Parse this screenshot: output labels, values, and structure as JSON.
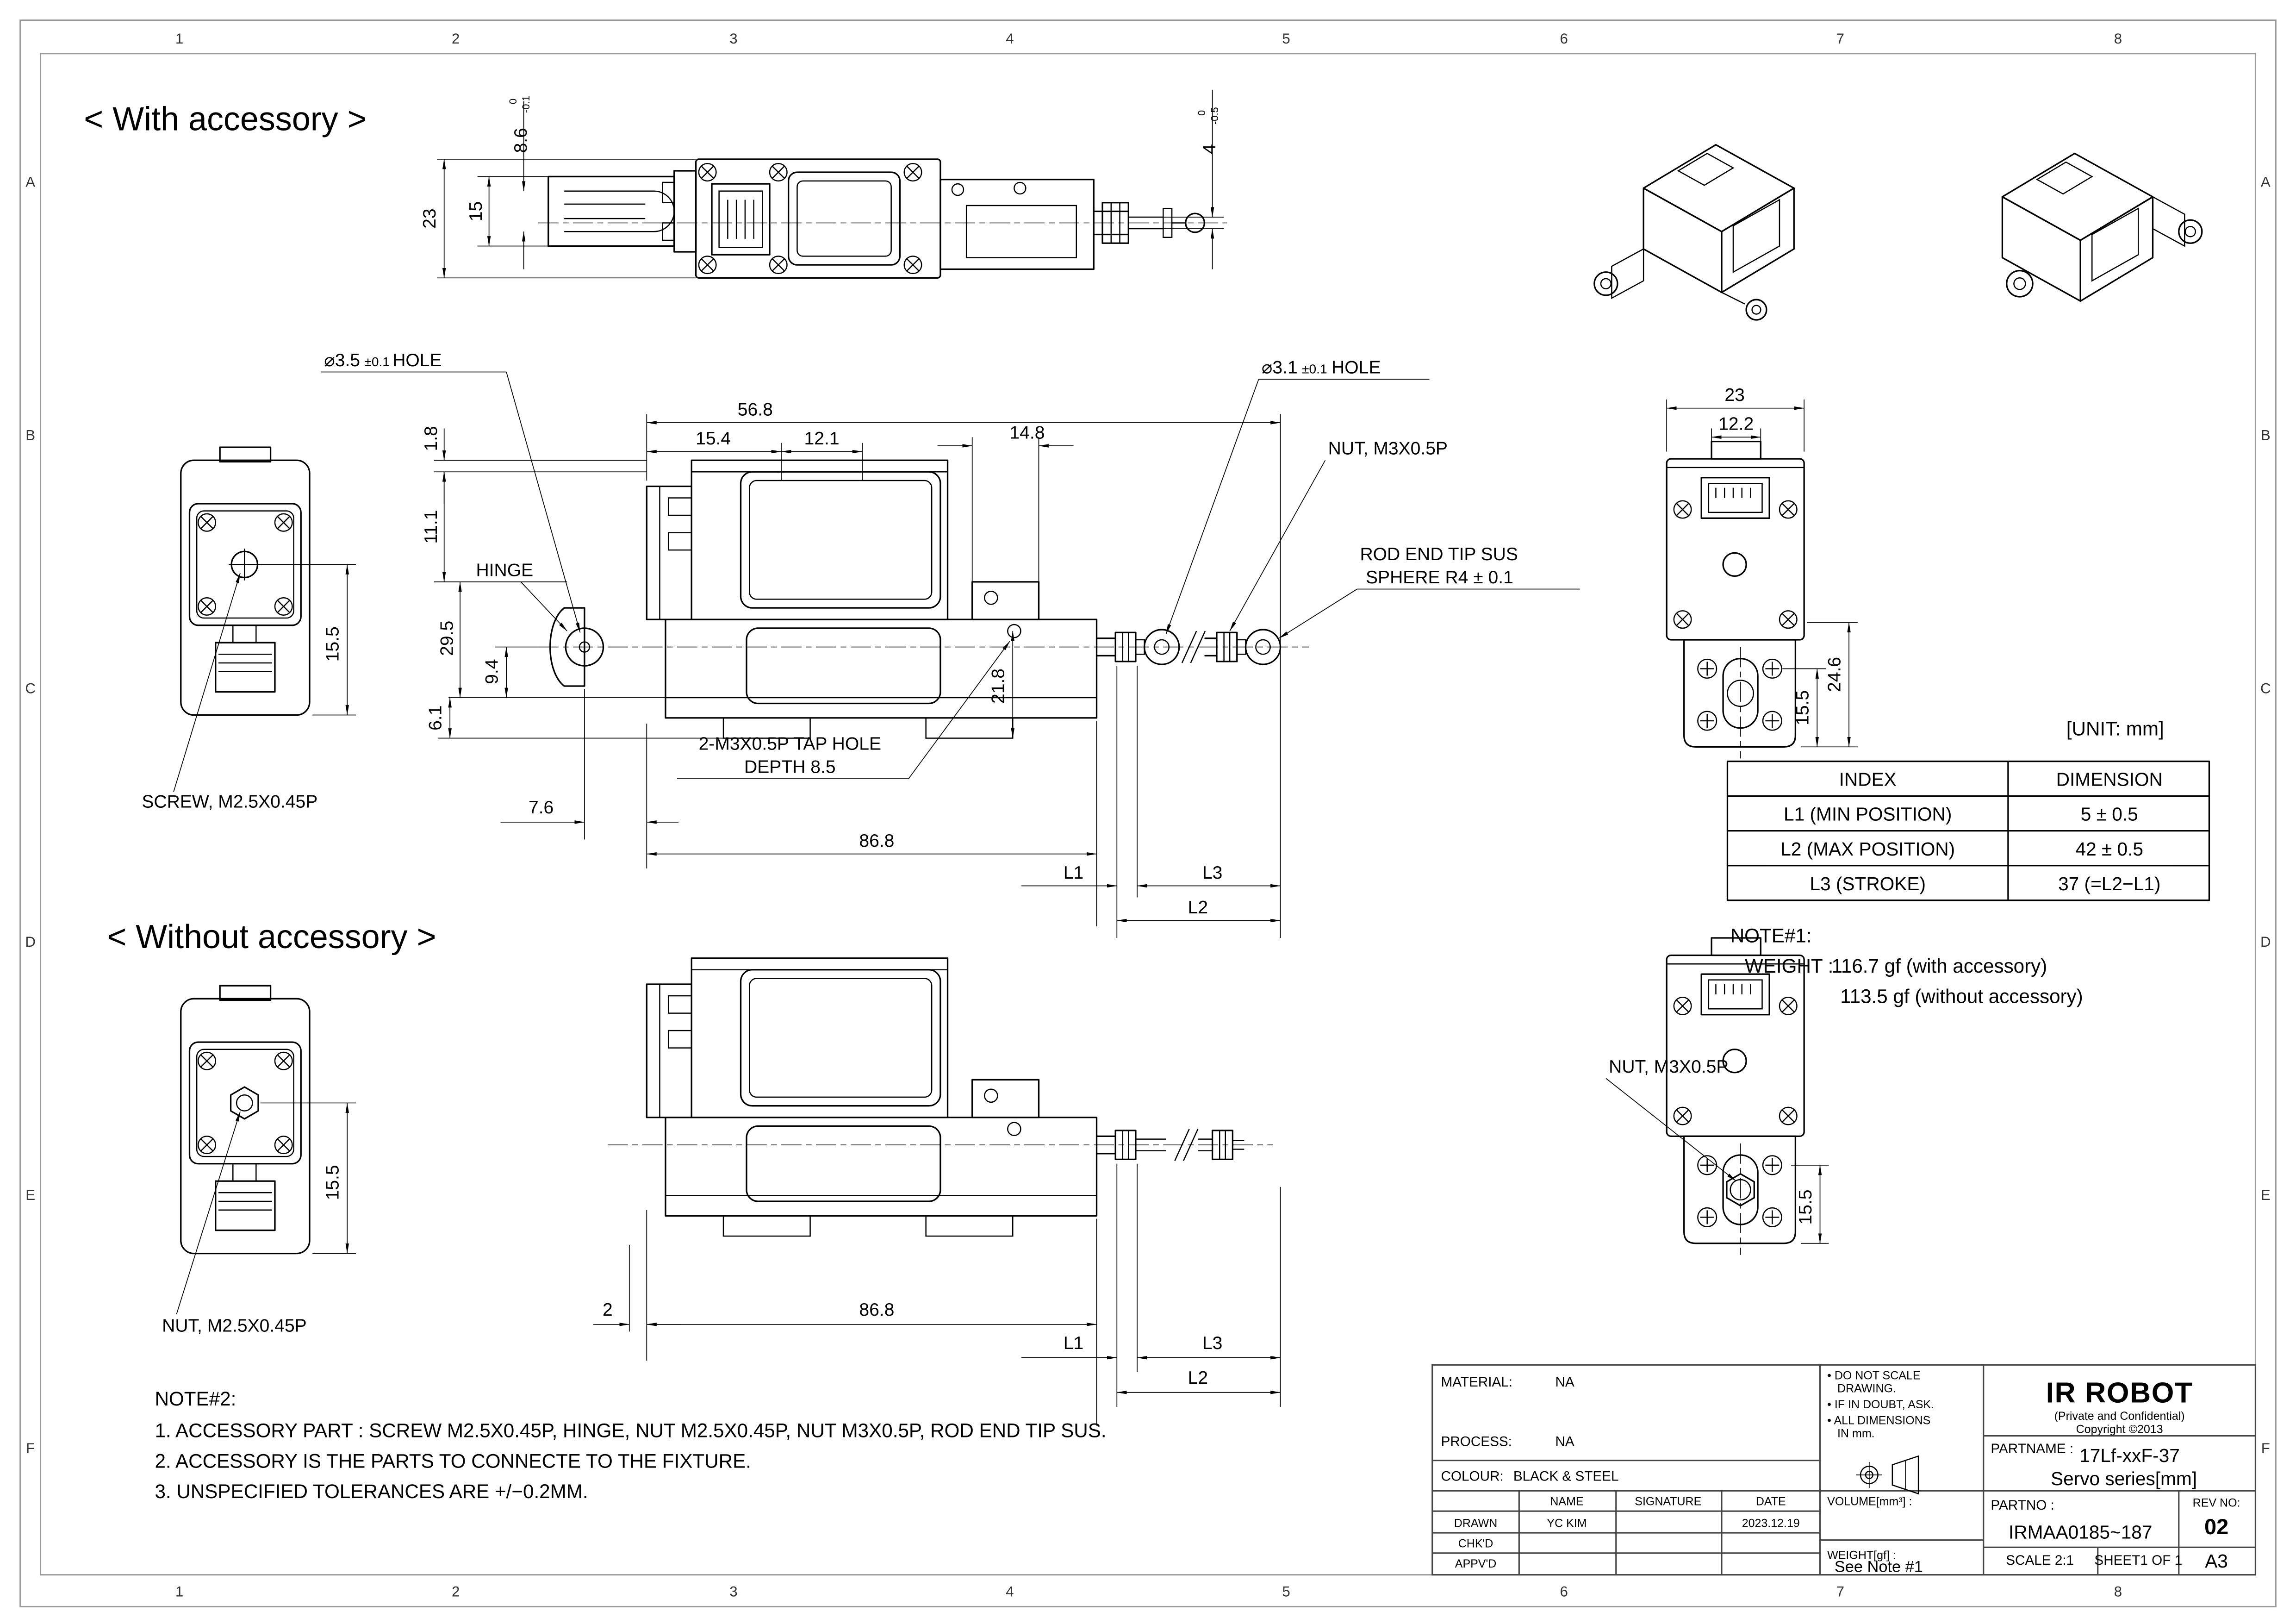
{
  "border": {
    "columns": [
      "1",
      "2",
      "3",
      "4",
      "5",
      "6",
      "7",
      "8"
    ],
    "rows": [
      "A",
      "B",
      "C",
      "D",
      "E",
      "F"
    ]
  },
  "sections": {
    "with_accessory": "< With accessory >",
    "without_accessory": "< Without accessory >"
  },
  "unit_note": "[UNIT: mm]",
  "dims": {
    "common": {
      "d155": "15.5",
      "l1": "L1",
      "l2": "L2",
      "l3": "L3",
      "d868": "86.8"
    },
    "top_view": {
      "d23": "23",
      "d15": "15",
      "d86": "8.6",
      "d86_hi": "0",
      "d86_lo": "-0.1",
      "d4": "4",
      "d4_hi": "0",
      "d4_lo": "-0.5"
    },
    "front_view": {
      "hole35": "⌀3.5",
      "hole35_tol": "±0.1",
      "hole35_suffix": "HOLE",
      "d568": "56.8",
      "d154": "15.4",
      "d121": "12.1",
      "d18": "1.8",
      "d111": "11.1",
      "d295": "29.5",
      "d94": "9.4",
      "d61": "6.1",
      "d76": "7.6",
      "d148": "14.8",
      "d218": "21.8",
      "hinge": "HINGE",
      "screw": "SCREW, M2.5X0.45P",
      "tap1": "2-M3X0.5P TAP HOLE",
      "tap2": "DEPTH 8.5",
      "hole31": "⌀3.1",
      "hole31_tol": "±0.1",
      "hole31_suffix": "HOLE",
      "nut_m3": "NUT, M3X0.5P",
      "rod1": "ROD END TIP SUS",
      "rod2": "SPHERE R4 ± 0.1"
    },
    "right_view": {
      "d23": "23",
      "d122": "12.2",
      "d246": "24.6"
    },
    "bottom_view": {
      "d2": "2",
      "nut_m25": "NUT, M2.5X0.45P",
      "nut_m3": "NUT, M3X0.5P"
    }
  },
  "index_table": {
    "headers": [
      "INDEX",
      "DIMENSION"
    ],
    "rows": [
      [
        "L1 (MIN POSITION)",
        "5 ± 0.5"
      ],
      [
        "L2 (MAX POSITION)",
        "42 ± 0.5"
      ],
      [
        "L3 (STROKE)",
        "37 (=L2−L1)"
      ]
    ]
  },
  "note1": {
    "title": "NOTE#1:",
    "weight_label": "WEIGHT :",
    "line1": "116.7 gf  (with accessory)",
    "line2": "113.5 gf  (without accessory)"
  },
  "note2": {
    "title": "NOTE#2:",
    "item1": "1. ACCESSORY PART :  SCREW M2.5X0.45P, HINGE, NUT M2.5X0.45P, NUT M3X0.5P, ROD END TIP SUS.",
    "item2": "2. ACCESSORY IS THE PARTS TO CONNECTE TO THE FIXTURE.",
    "item3": "3. UNSPECIFIED TOLERANCES ARE +/−0.2MM."
  },
  "title_block": {
    "material_label": "MATERIAL:",
    "material_value": "NA",
    "process_label": "PROCESS:",
    "process_value": "NA",
    "colour_label": "COLOUR:",
    "colour_value": "BLACK & STEEL",
    "col_name": "NAME",
    "col_signature": "SIGNATURE",
    "col_date": "DATE",
    "row_drawn": "DRAWN",
    "row_chkd": "CHK'D",
    "row_appvd": "APPV'D",
    "drawn_name": "YC KIM",
    "drawn_date": "2023.12.19",
    "note_a1": "• DO NOT SCALE",
    "note_a2": "DRAWING.",
    "note_b": "• IF IN DOUBT, ASK.",
    "note_c1": "• ALL DIMENSIONS",
    "note_c2": "IN mm.",
    "volume_label": "VOLUME[mm³] :",
    "weight_label": "WEIGHT[gf] :",
    "weight_value": "See Note #1",
    "company": "IR ROBOT",
    "confidential": "(Private and Confidential)",
    "copyright": "Copyright ©2013",
    "partname_label": "PARTNAME :",
    "partname_line1": "17Lf-xxF-37",
    "partname_line2": "Servo series[mm]",
    "partno_label": "PARTNO :",
    "partno_value": "IRMAA0185~187",
    "revno_label": "REV NO:",
    "revno_value": "02",
    "scale_label": "SCALE  2:1",
    "sheet_label": "SHEET1 OF 1",
    "size_label": "A3"
  }
}
